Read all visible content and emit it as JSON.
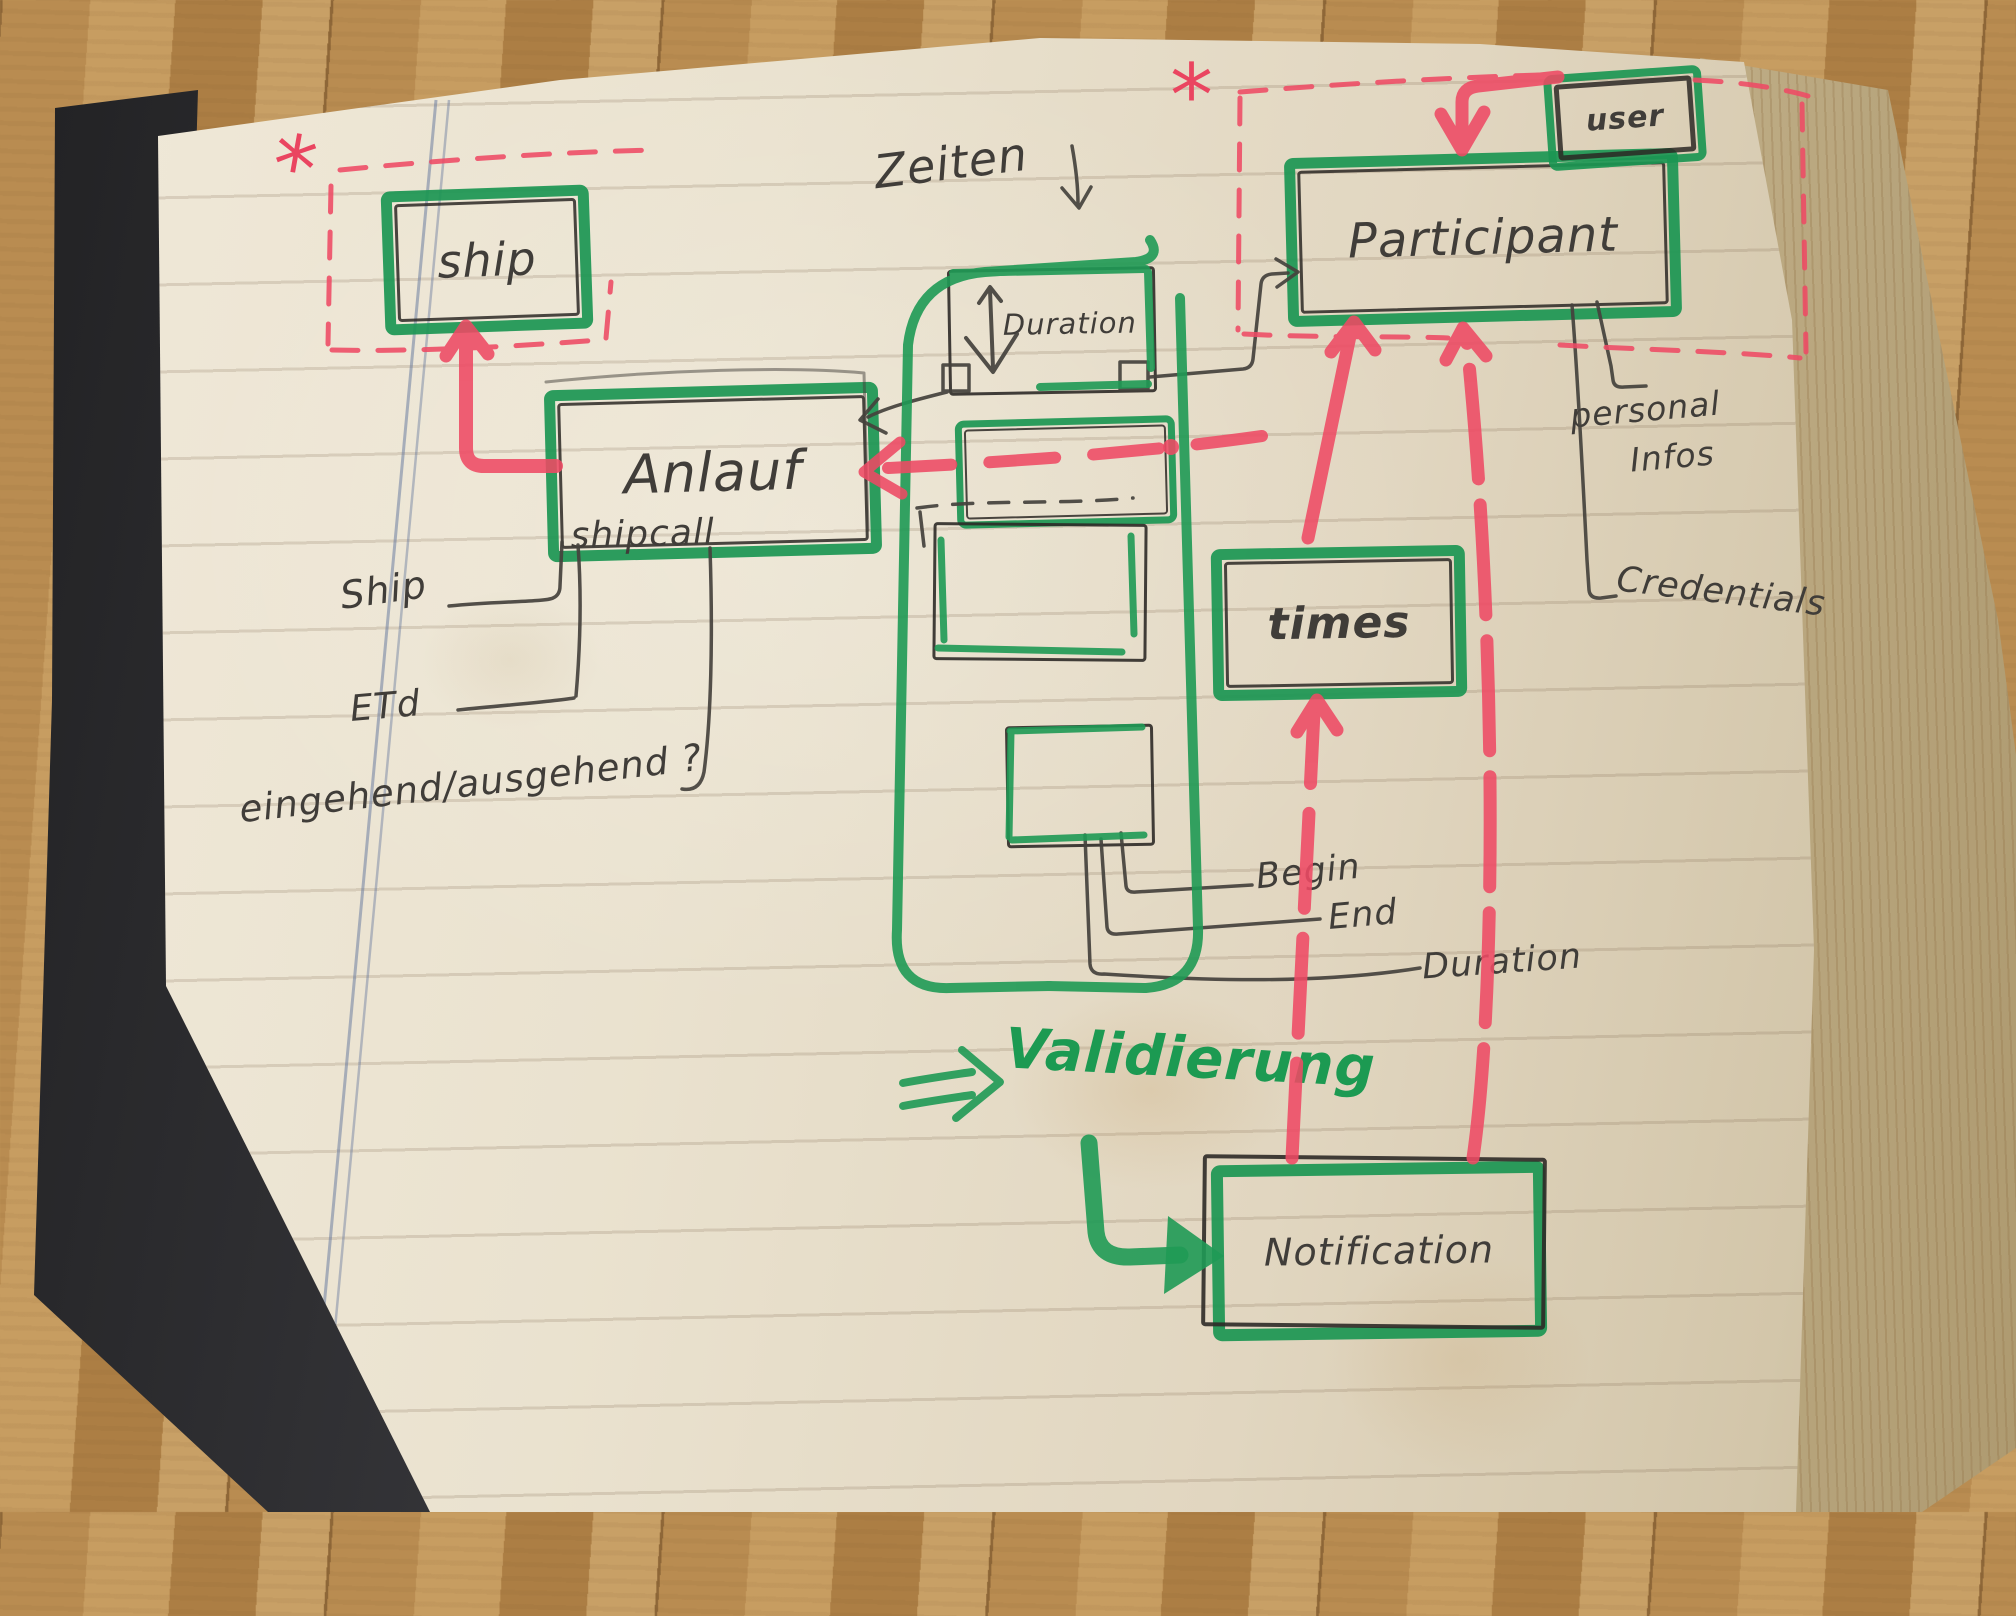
{
  "labels": {
    "ship_entity": "ship",
    "anlauf": "Anlauf",
    "shipcall": "shipcall",
    "participant": "Participant",
    "user": "user",
    "times": "times",
    "notification": "Notification",
    "duration_box": "Duration",
    "zeiten": "Zeiten",
    "validierung": "Validierung",
    "ship_attr": "Ship",
    "eta": "ETd",
    "in_out": "eingehend/ausgehend ?",
    "begin": "Begin",
    "end": "End",
    "duration_attr": "Duration",
    "personal_line1": "personal",
    "personal_line2": "Infos",
    "credentials": "Credentials",
    "asterisk": "*"
  },
  "colors": {
    "marker_green": "#1f9a55",
    "marker_red": "#ee4a64",
    "ink": "#403d39",
    "paper": "#e9e1cf"
  }
}
